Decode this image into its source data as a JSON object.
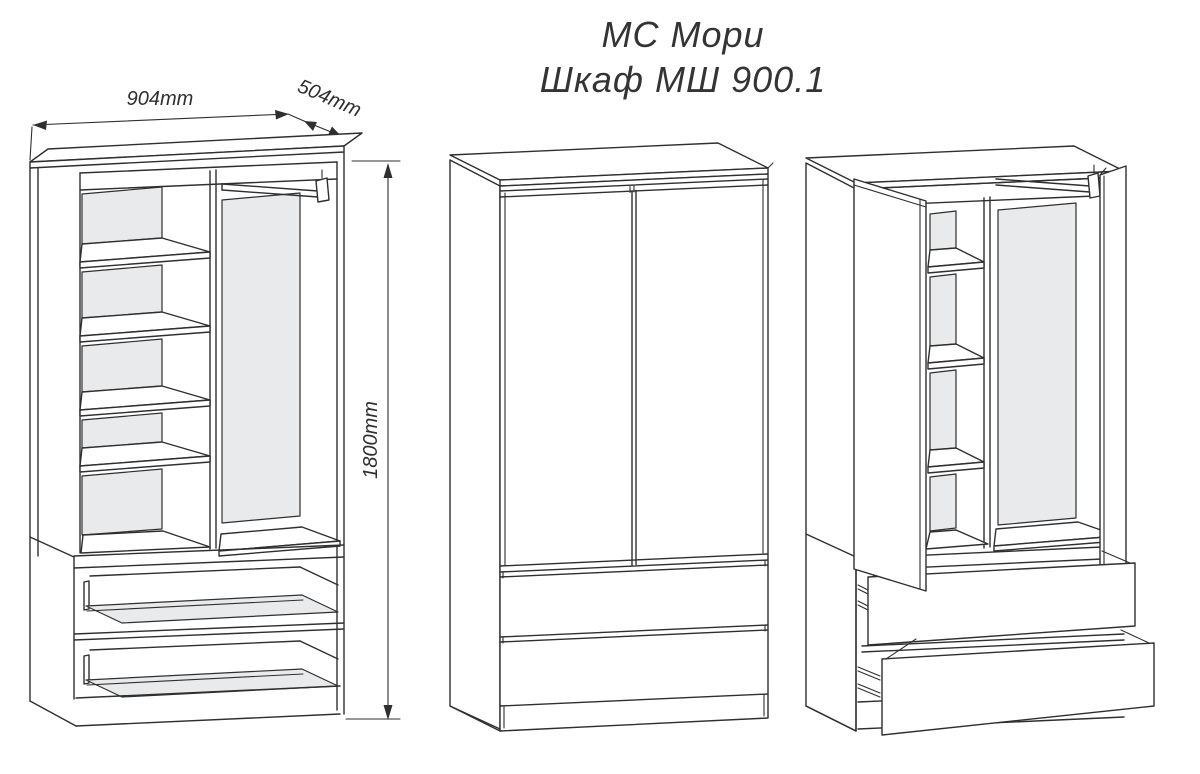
{
  "title": {
    "line1": "МС Мори",
    "line2": "Шкаф МШ 900.1"
  },
  "dims": {
    "width": "904mm",
    "depth": "504mm",
    "height": "1800mm"
  },
  "colors": {
    "line": "#2f2f2f",
    "back_panel_fill": "#e9eaeb",
    "background": "#ffffff"
  }
}
